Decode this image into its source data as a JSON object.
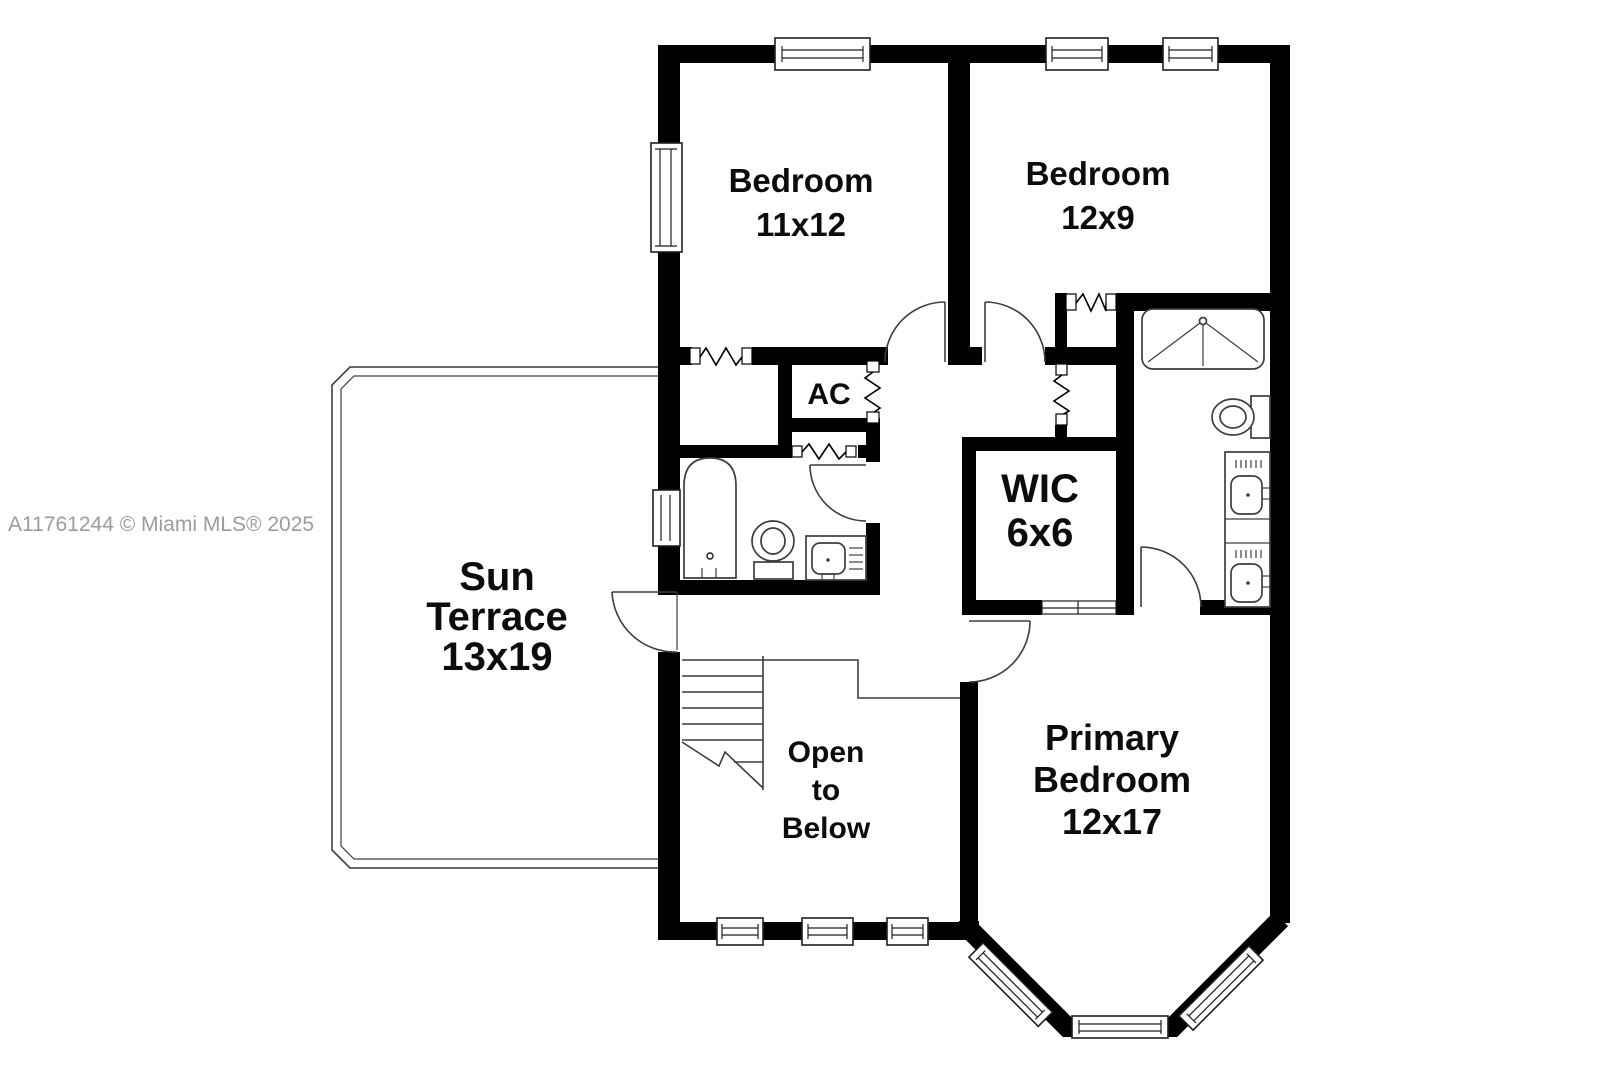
{
  "watermark": {
    "text": "A11761244 © Miami MLS® 2025",
    "color": "#9c9c9c"
  },
  "colors": {
    "wall": "#000000",
    "thin_line": "#3d3d3d",
    "background": "#ffffff",
    "label": "#0c0c0c"
  },
  "rooms": {
    "bedroom1": {
      "name": "Bedroom",
      "dim": "11x12"
    },
    "bedroom2": {
      "name": "Bedroom",
      "dim": "12x9"
    },
    "ac_closet": {
      "name": "AC"
    },
    "wic": {
      "name": "WIC",
      "dim": "6x6"
    },
    "sun_terrace": {
      "name_line1": "Sun",
      "name_line2": "Terrace",
      "dim": "13x19"
    },
    "open_to_below": {
      "line1": "Open",
      "line2": "to",
      "line3": "Below"
    },
    "primary_bedroom": {
      "name_line1": "Primary",
      "name_line2": "Bedroom",
      "dim": "12x17"
    }
  },
  "icons": [
    "window-icon",
    "door-swing-icon",
    "bifold-door-icon",
    "stairs-icon",
    "bathtub-icon",
    "toilet-icon",
    "sink-icon",
    "shower-icon",
    "vanity-icon"
  ]
}
